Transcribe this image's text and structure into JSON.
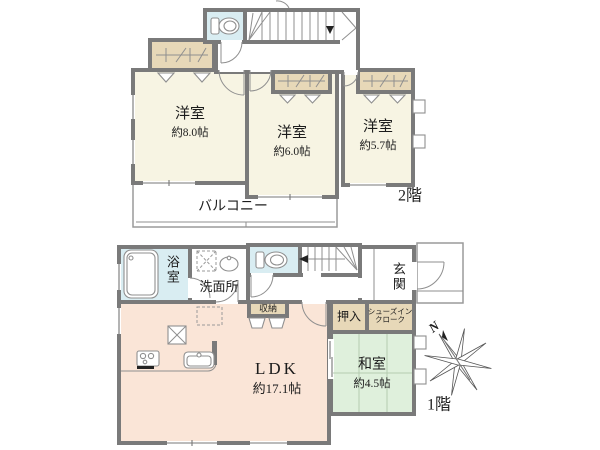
{
  "colors": {
    "wall": "#7a7a7a",
    "cream": "#f7f4e3",
    "tan": "#e7d8b8",
    "blue": "#d9edf2",
    "pink": "#fae5d7",
    "green": "#dff0dc"
  },
  "floor2": {
    "label": "2階",
    "rooms": [
      {
        "name": "洋室",
        "size": "約8.0帖"
      },
      {
        "name": "洋室",
        "size": "約6.0帖"
      },
      {
        "name": "洋室",
        "size": "約5.7帖"
      }
    ],
    "balcony": "バルコニー"
  },
  "floor1": {
    "label": "1階",
    "ldk": {
      "name": "LDK",
      "size": "約17.1帖"
    },
    "washitsu": {
      "name": "和室",
      "size": "約4.5帖"
    },
    "bath": "浴室",
    "washroom": "洗面所",
    "entrance": "玄関",
    "oshiire": "押入",
    "storage": "収納",
    "shoe_closet": {
      "line1": "シューズイン",
      "line2": "クローク"
    }
  },
  "compass": {
    "north": "N"
  }
}
